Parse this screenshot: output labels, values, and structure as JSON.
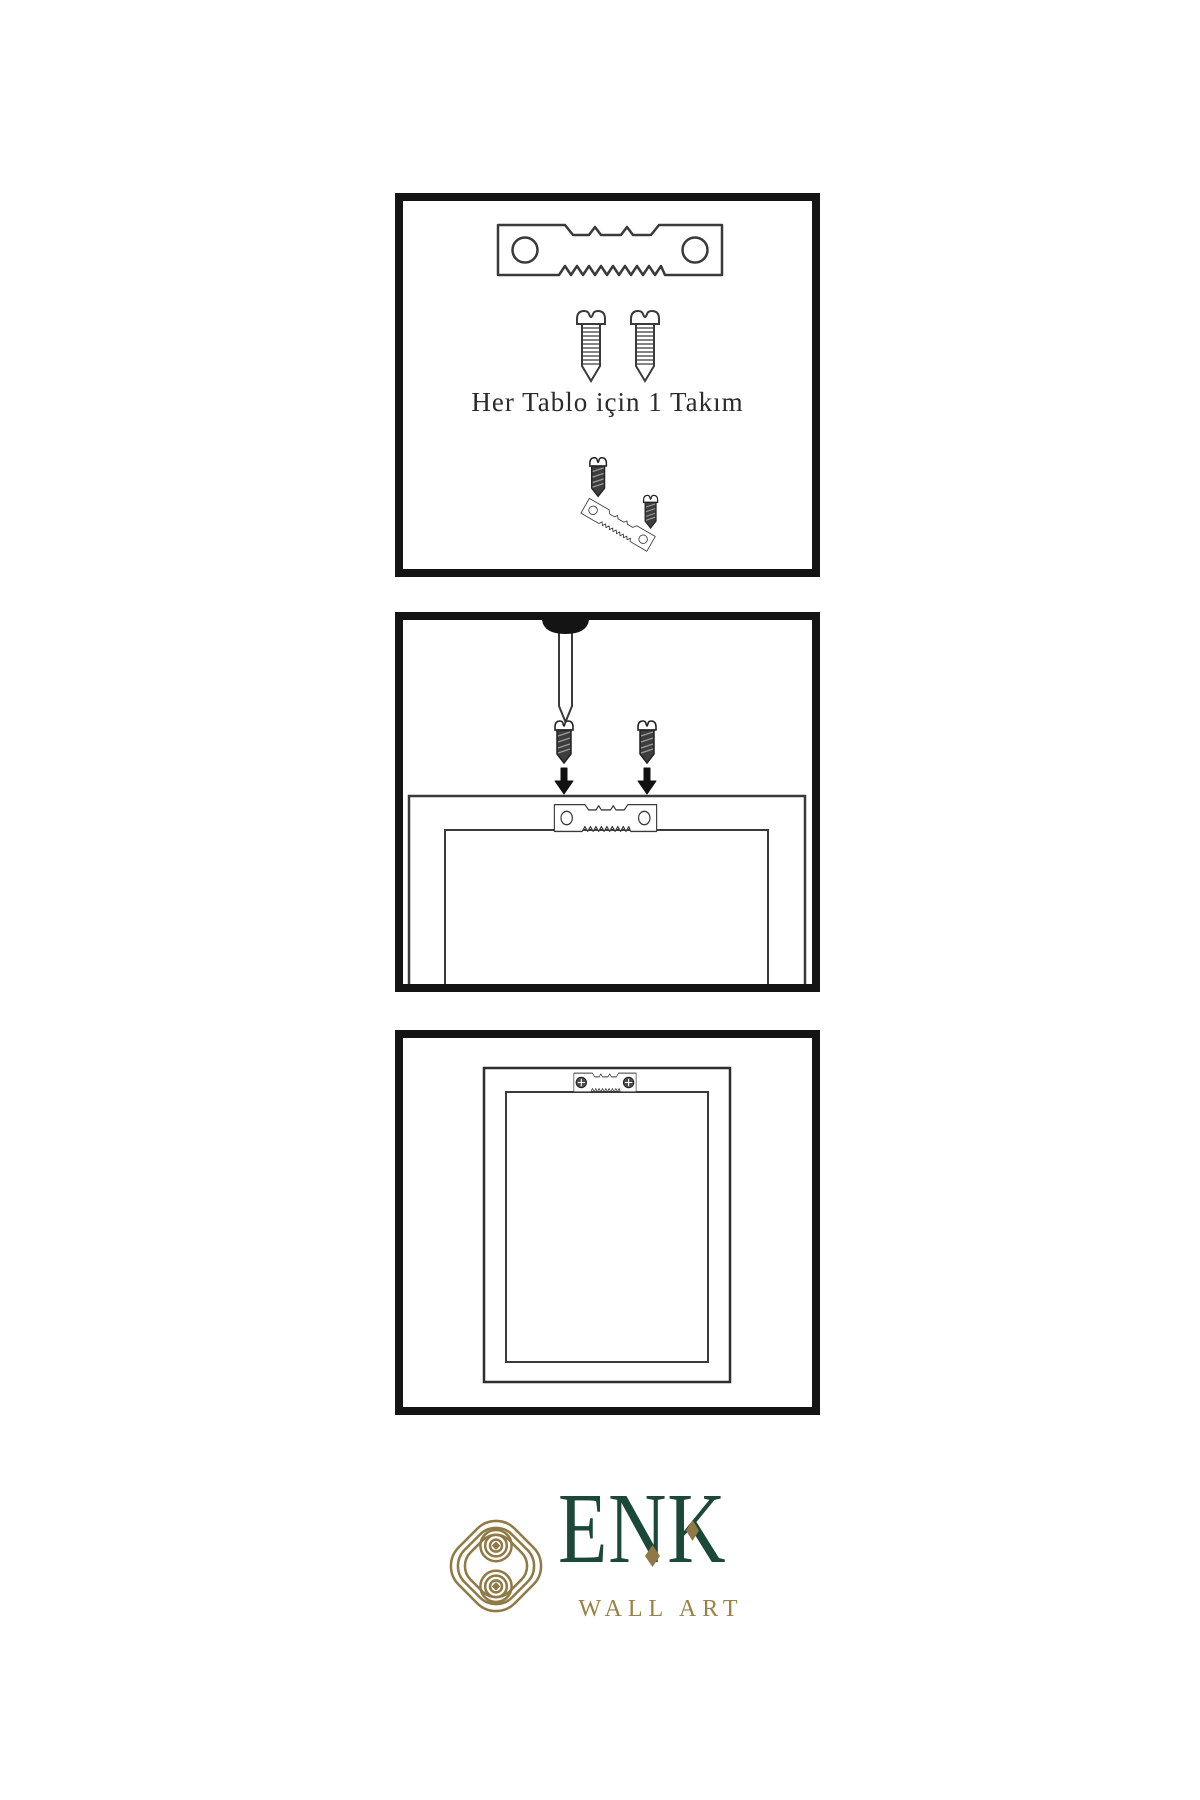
{
  "page": {
    "background": "#ffffff",
    "panel_border_color": "#141414",
    "line_color": "#3a3a3a"
  },
  "instructions": {
    "step1": {
      "caption": "Her Tablo için 1 Takım",
      "icons": [
        "sawtooth-hanger-icon",
        "screw-icon",
        "screw-icon",
        "screw-into-hanger-icon"
      ]
    },
    "step2": {
      "icons": [
        "wall-nail-icon",
        "screw-icon",
        "screw-icon",
        "arrow-down-icon",
        "arrow-down-icon",
        "frame-back-with-hanger-icon"
      ]
    },
    "step3": {
      "icons": [
        "hung-frame-icon",
        "mounted-sawtooth-hanger-icon"
      ]
    }
  },
  "logo": {
    "brand": "ENK",
    "tagline": "WALL ART",
    "icon": "knot-monogram-icon",
    "colors": {
      "brand_green": "#1b4839",
      "brand_gold": "#8f7a45"
    }
  }
}
